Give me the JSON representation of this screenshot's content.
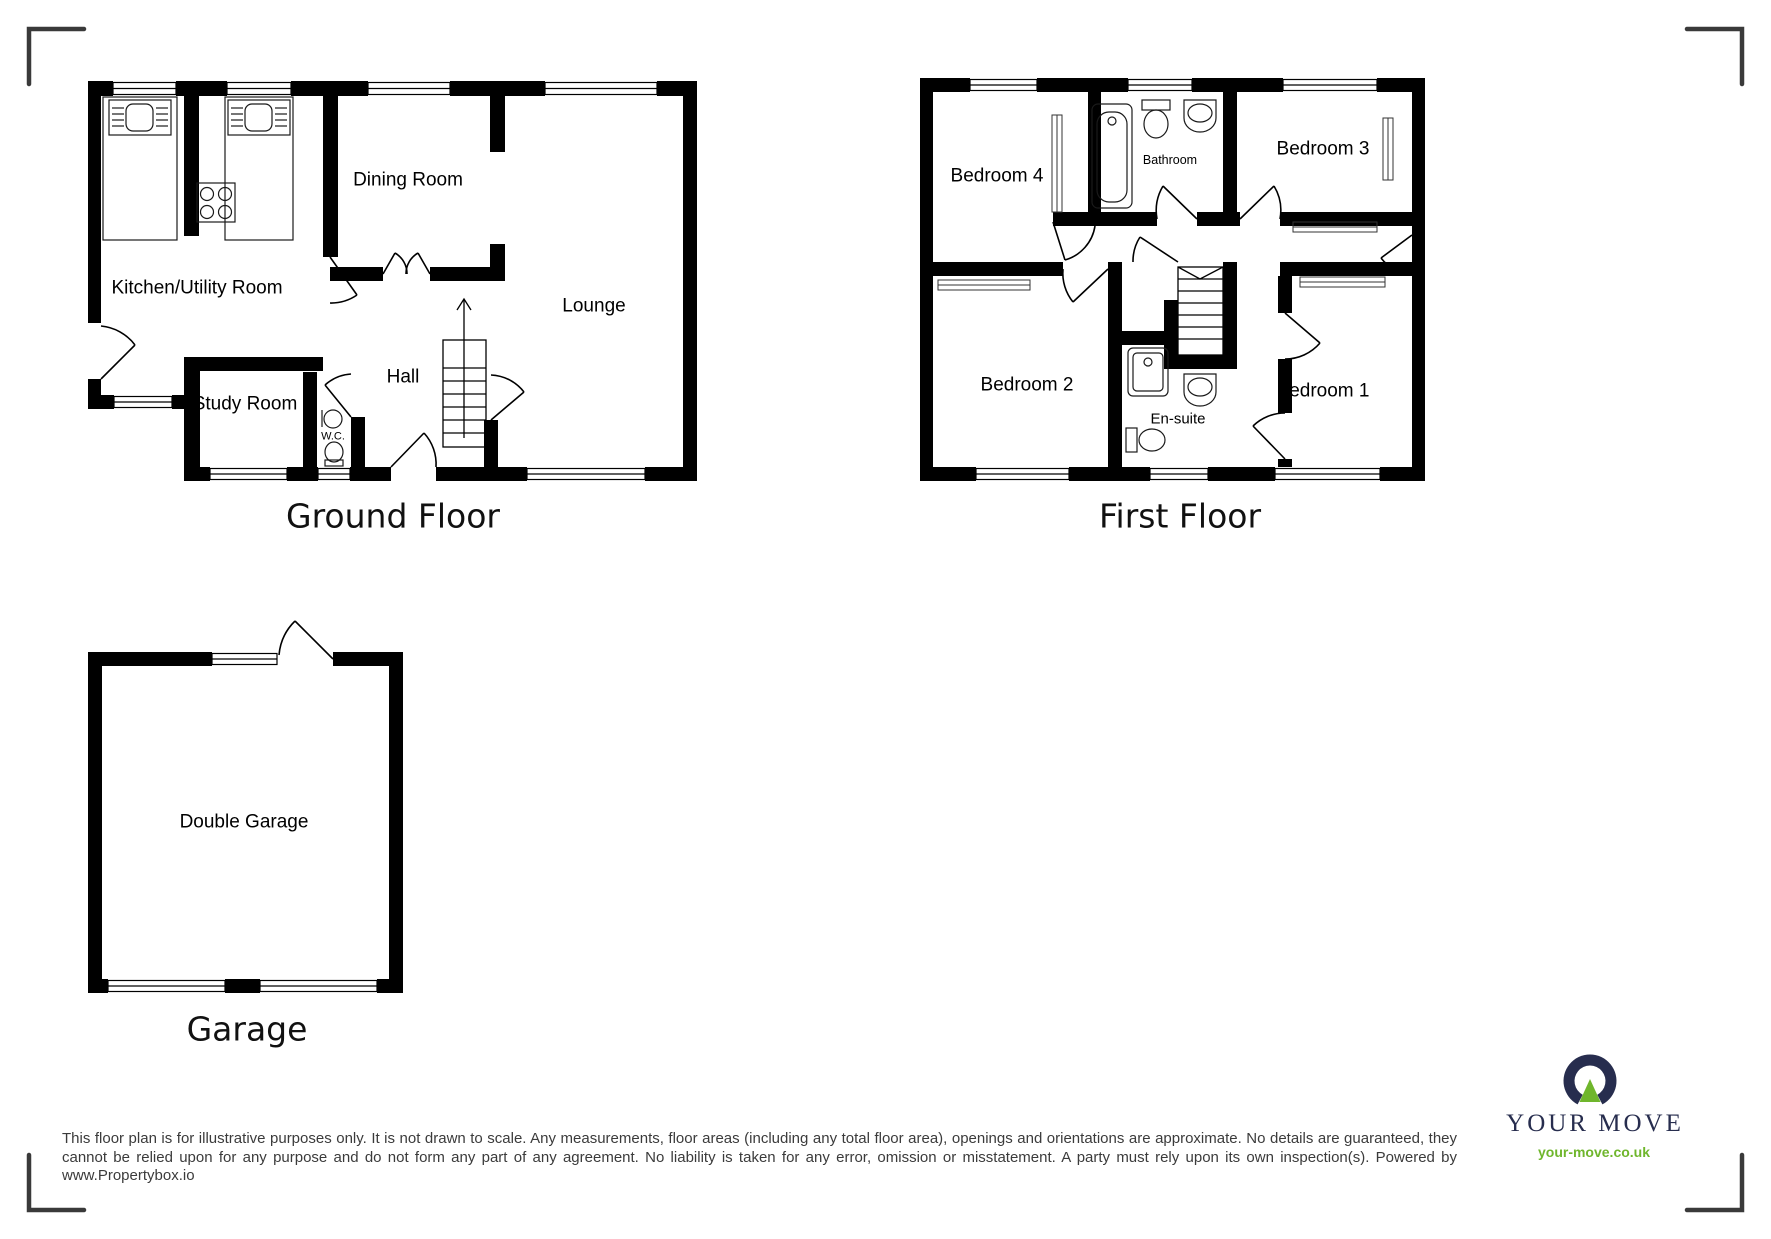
{
  "floors": {
    "ground": {
      "title": "Ground Floor",
      "rooms": {
        "kitchen": "Kitchen/Utility Room",
        "dining": "Dining Room",
        "lounge": "Lounge",
        "hall": "Hall",
        "study": "Study Room",
        "wc": "W.C."
      }
    },
    "first": {
      "title": "First Floor",
      "rooms": {
        "bed4": "Bedroom 4",
        "bathroom": "Bathroom",
        "bed3": "Bedroom 3",
        "bed2": "Bedroom 2",
        "ensuite": "En-suite",
        "bed1": "Bedroom 1"
      }
    },
    "garage": {
      "title": "Garage",
      "rooms": {
        "double_garage": "Double Garage"
      }
    }
  },
  "disclaimer": "This floor plan is for illustrative purposes only. It is not drawn to scale. Any measurements, floor areas (including any total floor area), openings and orientations are approximate. No details are guaranteed, they cannot be relied upon for any purpose and do not form any part of any agreement. No liability is taken for any error, omission or misstatement. A party must rely upon its own inspection(s). Powered by www.Propertybox.io",
  "branding": {
    "name": "YOUR MOVE",
    "website": "your-move.co.uk",
    "navy": "#272d4e",
    "green": "#6fb62c"
  }
}
